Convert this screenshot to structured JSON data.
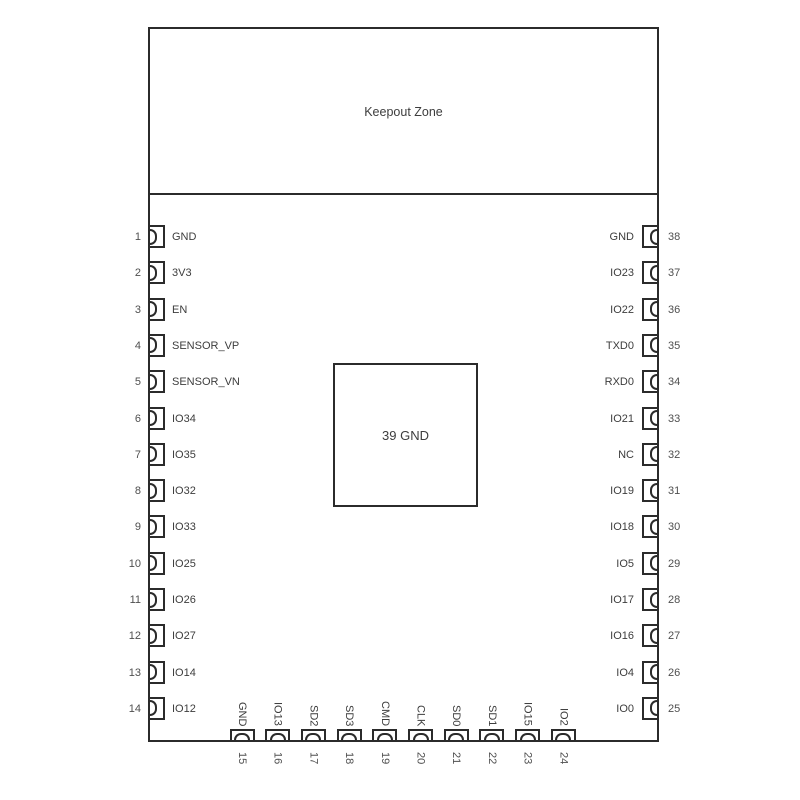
{
  "diagram": {
    "keepout_label": "Keepout Zone",
    "center_pad_label": "39 GND",
    "left_pins": [
      {
        "num": "1",
        "name": "GND"
      },
      {
        "num": "2",
        "name": "3V3"
      },
      {
        "num": "3",
        "name": "EN"
      },
      {
        "num": "4",
        "name": "SENSOR_VP"
      },
      {
        "num": "5",
        "name": "SENSOR_VN"
      },
      {
        "num": "6",
        "name": "IO34"
      },
      {
        "num": "7",
        "name": "IO35"
      },
      {
        "num": "8",
        "name": "IO32"
      },
      {
        "num": "9",
        "name": "IO33"
      },
      {
        "num": "10",
        "name": "IO25"
      },
      {
        "num": "11",
        "name": "IO26"
      },
      {
        "num": "12",
        "name": "IO27"
      },
      {
        "num": "13",
        "name": "IO14"
      },
      {
        "num": "14",
        "name": "IO12"
      }
    ],
    "right_pins": [
      {
        "num": "38",
        "name": "GND"
      },
      {
        "num": "37",
        "name": "IO23"
      },
      {
        "num": "36",
        "name": "IO22"
      },
      {
        "num": "35",
        "name": "TXD0"
      },
      {
        "num": "34",
        "name": "RXD0"
      },
      {
        "num": "33",
        "name": "IO21"
      },
      {
        "num": "32",
        "name": "NC"
      },
      {
        "num": "31",
        "name": "IO19"
      },
      {
        "num": "30",
        "name": "IO18"
      },
      {
        "num": "29",
        "name": "IO5"
      },
      {
        "num": "28",
        "name": "IO17"
      },
      {
        "num": "27",
        "name": "IO16"
      },
      {
        "num": "26",
        "name": "IO4"
      },
      {
        "num": "25",
        "name": "IO0"
      }
    ],
    "bottom_pins": [
      {
        "num": "15",
        "name": "GND"
      },
      {
        "num": "16",
        "name": "IO13"
      },
      {
        "num": "17",
        "name": "SD2"
      },
      {
        "num": "18",
        "name": "SD3"
      },
      {
        "num": "19",
        "name": "CMD"
      },
      {
        "num": "20",
        "name": "CLK"
      },
      {
        "num": "21",
        "name": "SD0"
      },
      {
        "num": "22",
        "name": "SD1"
      },
      {
        "num": "23",
        "name": "IO15"
      },
      {
        "num": "24",
        "name": "IO2"
      }
    ],
    "colors": {
      "line": "#2b2b2b",
      "label": "#3d3d3d",
      "number": "#4f4f4f",
      "background": "#ffffff"
    }
  }
}
